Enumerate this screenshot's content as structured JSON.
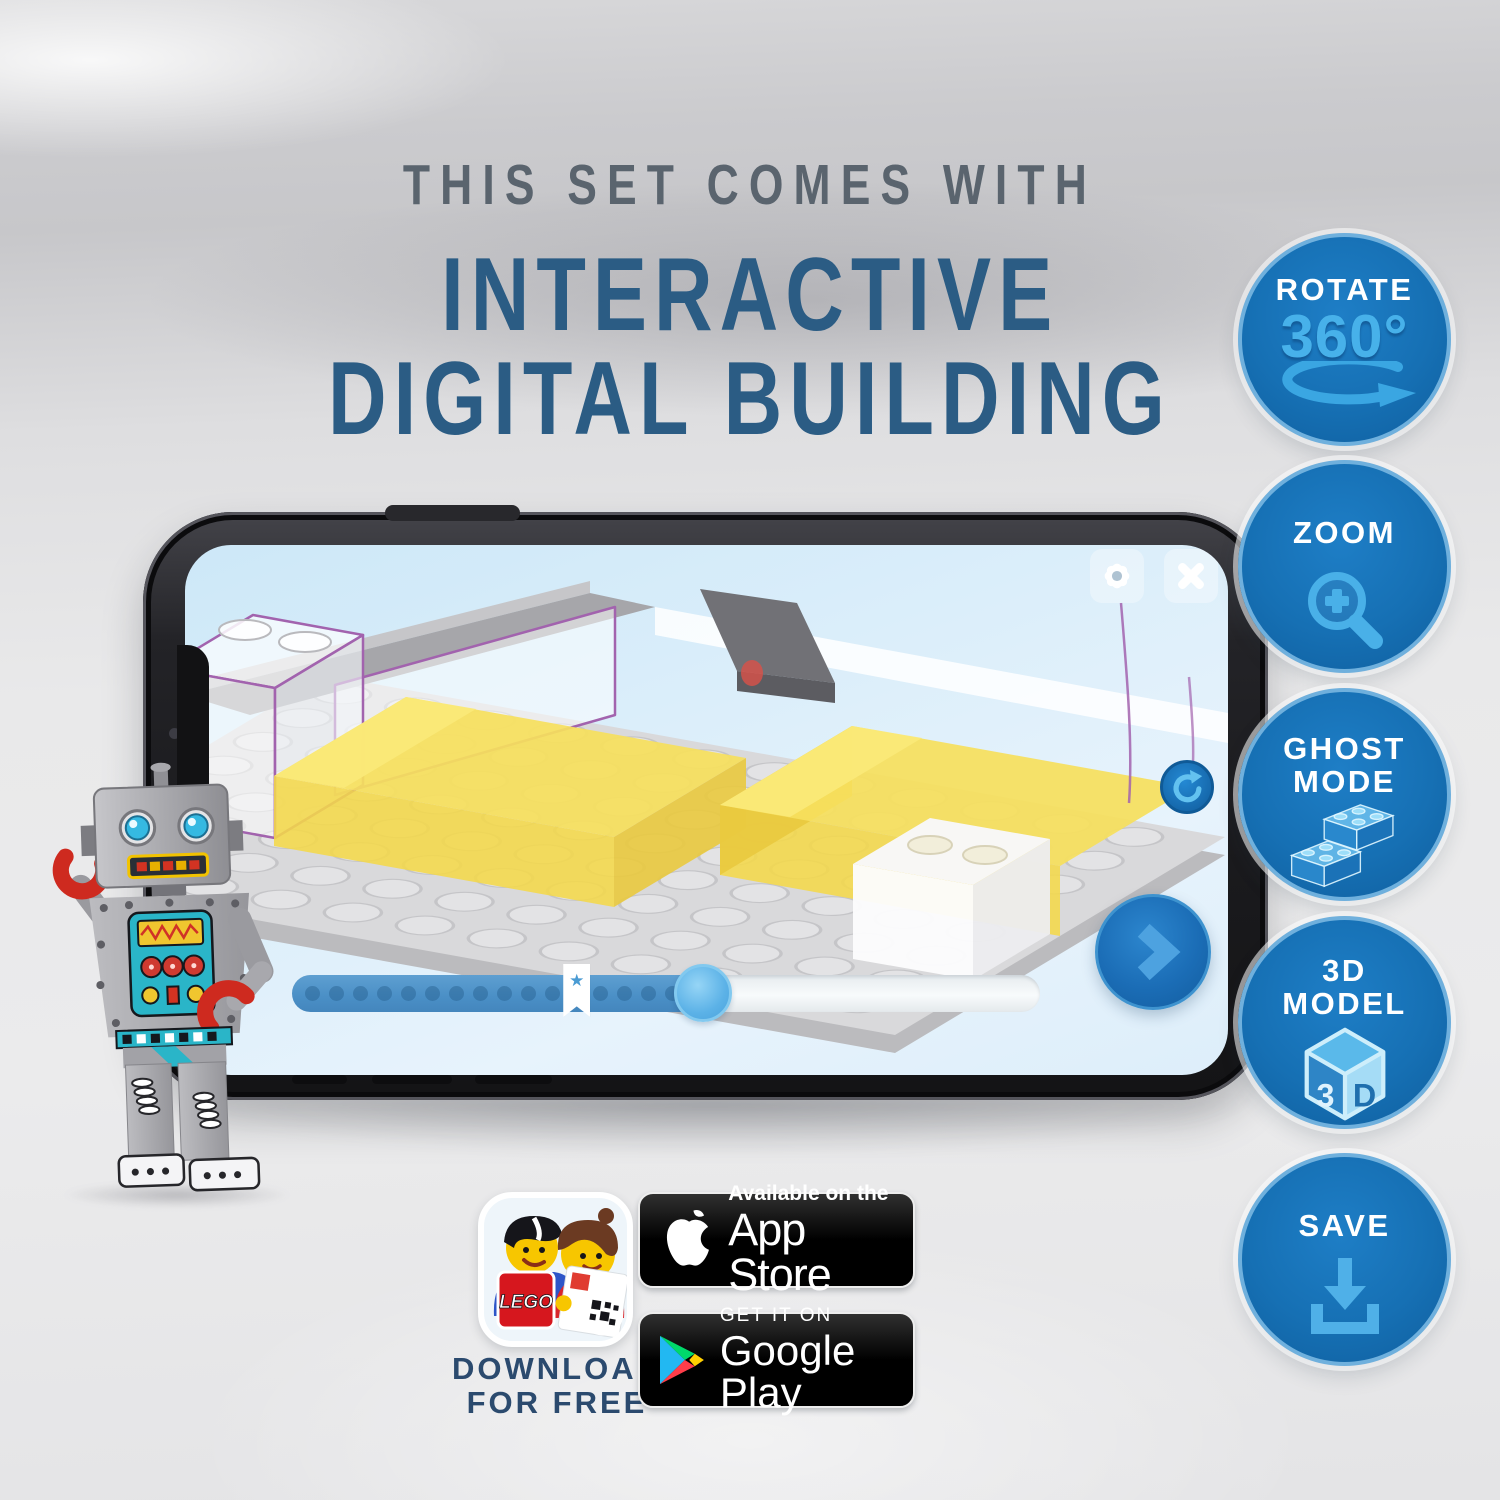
{
  "title": {
    "kicker": "THIS SET COMES WITH",
    "line1": "INTERACTIVE",
    "line2": "DIGITAL BUILDING"
  },
  "features": [
    {
      "label": "ROTATE",
      "icon": "rotate-360-icon",
      "icon_text": "360°"
    },
    {
      "label": "ZOOM",
      "icon": "zoom-magnifier-icon"
    },
    {
      "label": "GHOST",
      "label2": "MODE",
      "icon": "ghost-mode-brick-icon"
    },
    {
      "label": "3D",
      "label2": "MODEL",
      "icon": "3d-model-cube-icon",
      "cube_left": "3",
      "cube_right": "D"
    },
    {
      "label": "SAVE",
      "icon": "save-download-icon"
    }
  ],
  "phone_app": {
    "toolbar": {
      "settings_icon": "gear",
      "close_icon": "x-cross"
    },
    "controls": {
      "refresh_icon": "circular-arrow",
      "next_icon": "chevron-right"
    },
    "slider": {
      "progress_fraction": 0.55,
      "bookmark_fraction": 0.38,
      "bookmark_icon": "★"
    }
  },
  "download": {
    "line1": "DOWNLOAD",
    "line2": "FOR FREE",
    "app_logo_text": "LEGO"
  },
  "stores": {
    "app_store": {
      "tagline": "Available on the",
      "name": "App Store"
    },
    "google_play": {
      "tagline": "GET IT ON",
      "name": "Google Play"
    }
  },
  "icons": {
    "rotate-360-icon": "elliptical-rotate-arrow",
    "zoom-magnifier-icon": "magnifier-with-plus",
    "ghost-mode-brick-icon": "translucent-lego-bricks",
    "3d-model-cube-icon": "isometric-cube-3d",
    "save-download-icon": "download-arrow-tray",
    "settings-gear-icon": "gear",
    "close-icon": "x-cross",
    "refresh-icon": "circular-arrow",
    "next-icon": "chevron-right",
    "bookmark-star-icon": "★",
    "apple-icon": "apple-logo",
    "google-play-icon": "play-triangle"
  },
  "colors": {
    "badge_blue": "#1670b4",
    "badge_light_blue": "#47b1ea",
    "title_blue": "#2b5c84",
    "title_gray": "#5a646e",
    "lego_red": "#d6171e",
    "slider_fill": "#4a8fc6"
  }
}
